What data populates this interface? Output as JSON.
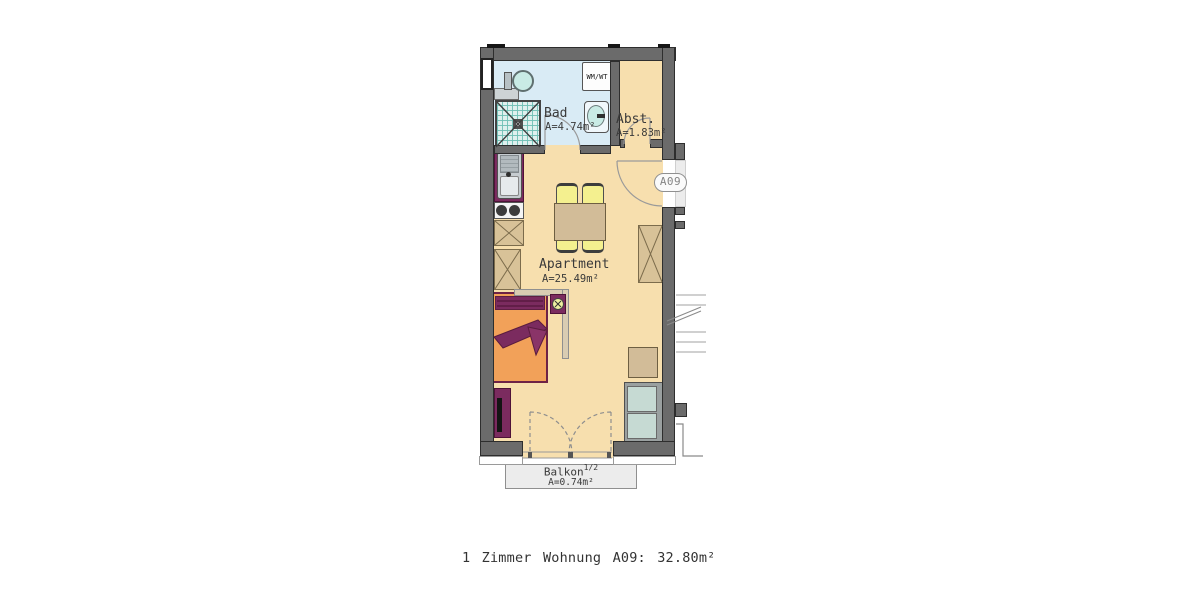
{
  "plan": {
    "unit_badge": "A09",
    "rooms": {
      "bad": {
        "name": "Bad",
        "area": "A=4.74m²"
      },
      "abstellraum": {
        "name": "Abst.",
        "area": "A=1.83m²"
      },
      "apartment": {
        "name": "Apartment",
        "area": "A=25.49m²"
      },
      "balkon": {
        "name": "Balkon",
        "share_superscript": "1/2",
        "area": "A=0.74m²"
      }
    },
    "fixtures": {
      "washer_label": "WM/WT"
    },
    "colors": {
      "wall": "#6b6b6b",
      "bathroom_floor": "#d9ebf5",
      "living_floor": "#f7dfae",
      "furniture_wood": "#d2bc98",
      "accent_purple": "#7b2b5f",
      "bed_orange": "#f2a159",
      "chair_yellow": "#f4f08f",
      "fixture_teal": "#c9ebe5",
      "balcony_gray": "#ececec"
    }
  },
  "caption": "1 Zimmer Wohnung A09:  32.80m²"
}
